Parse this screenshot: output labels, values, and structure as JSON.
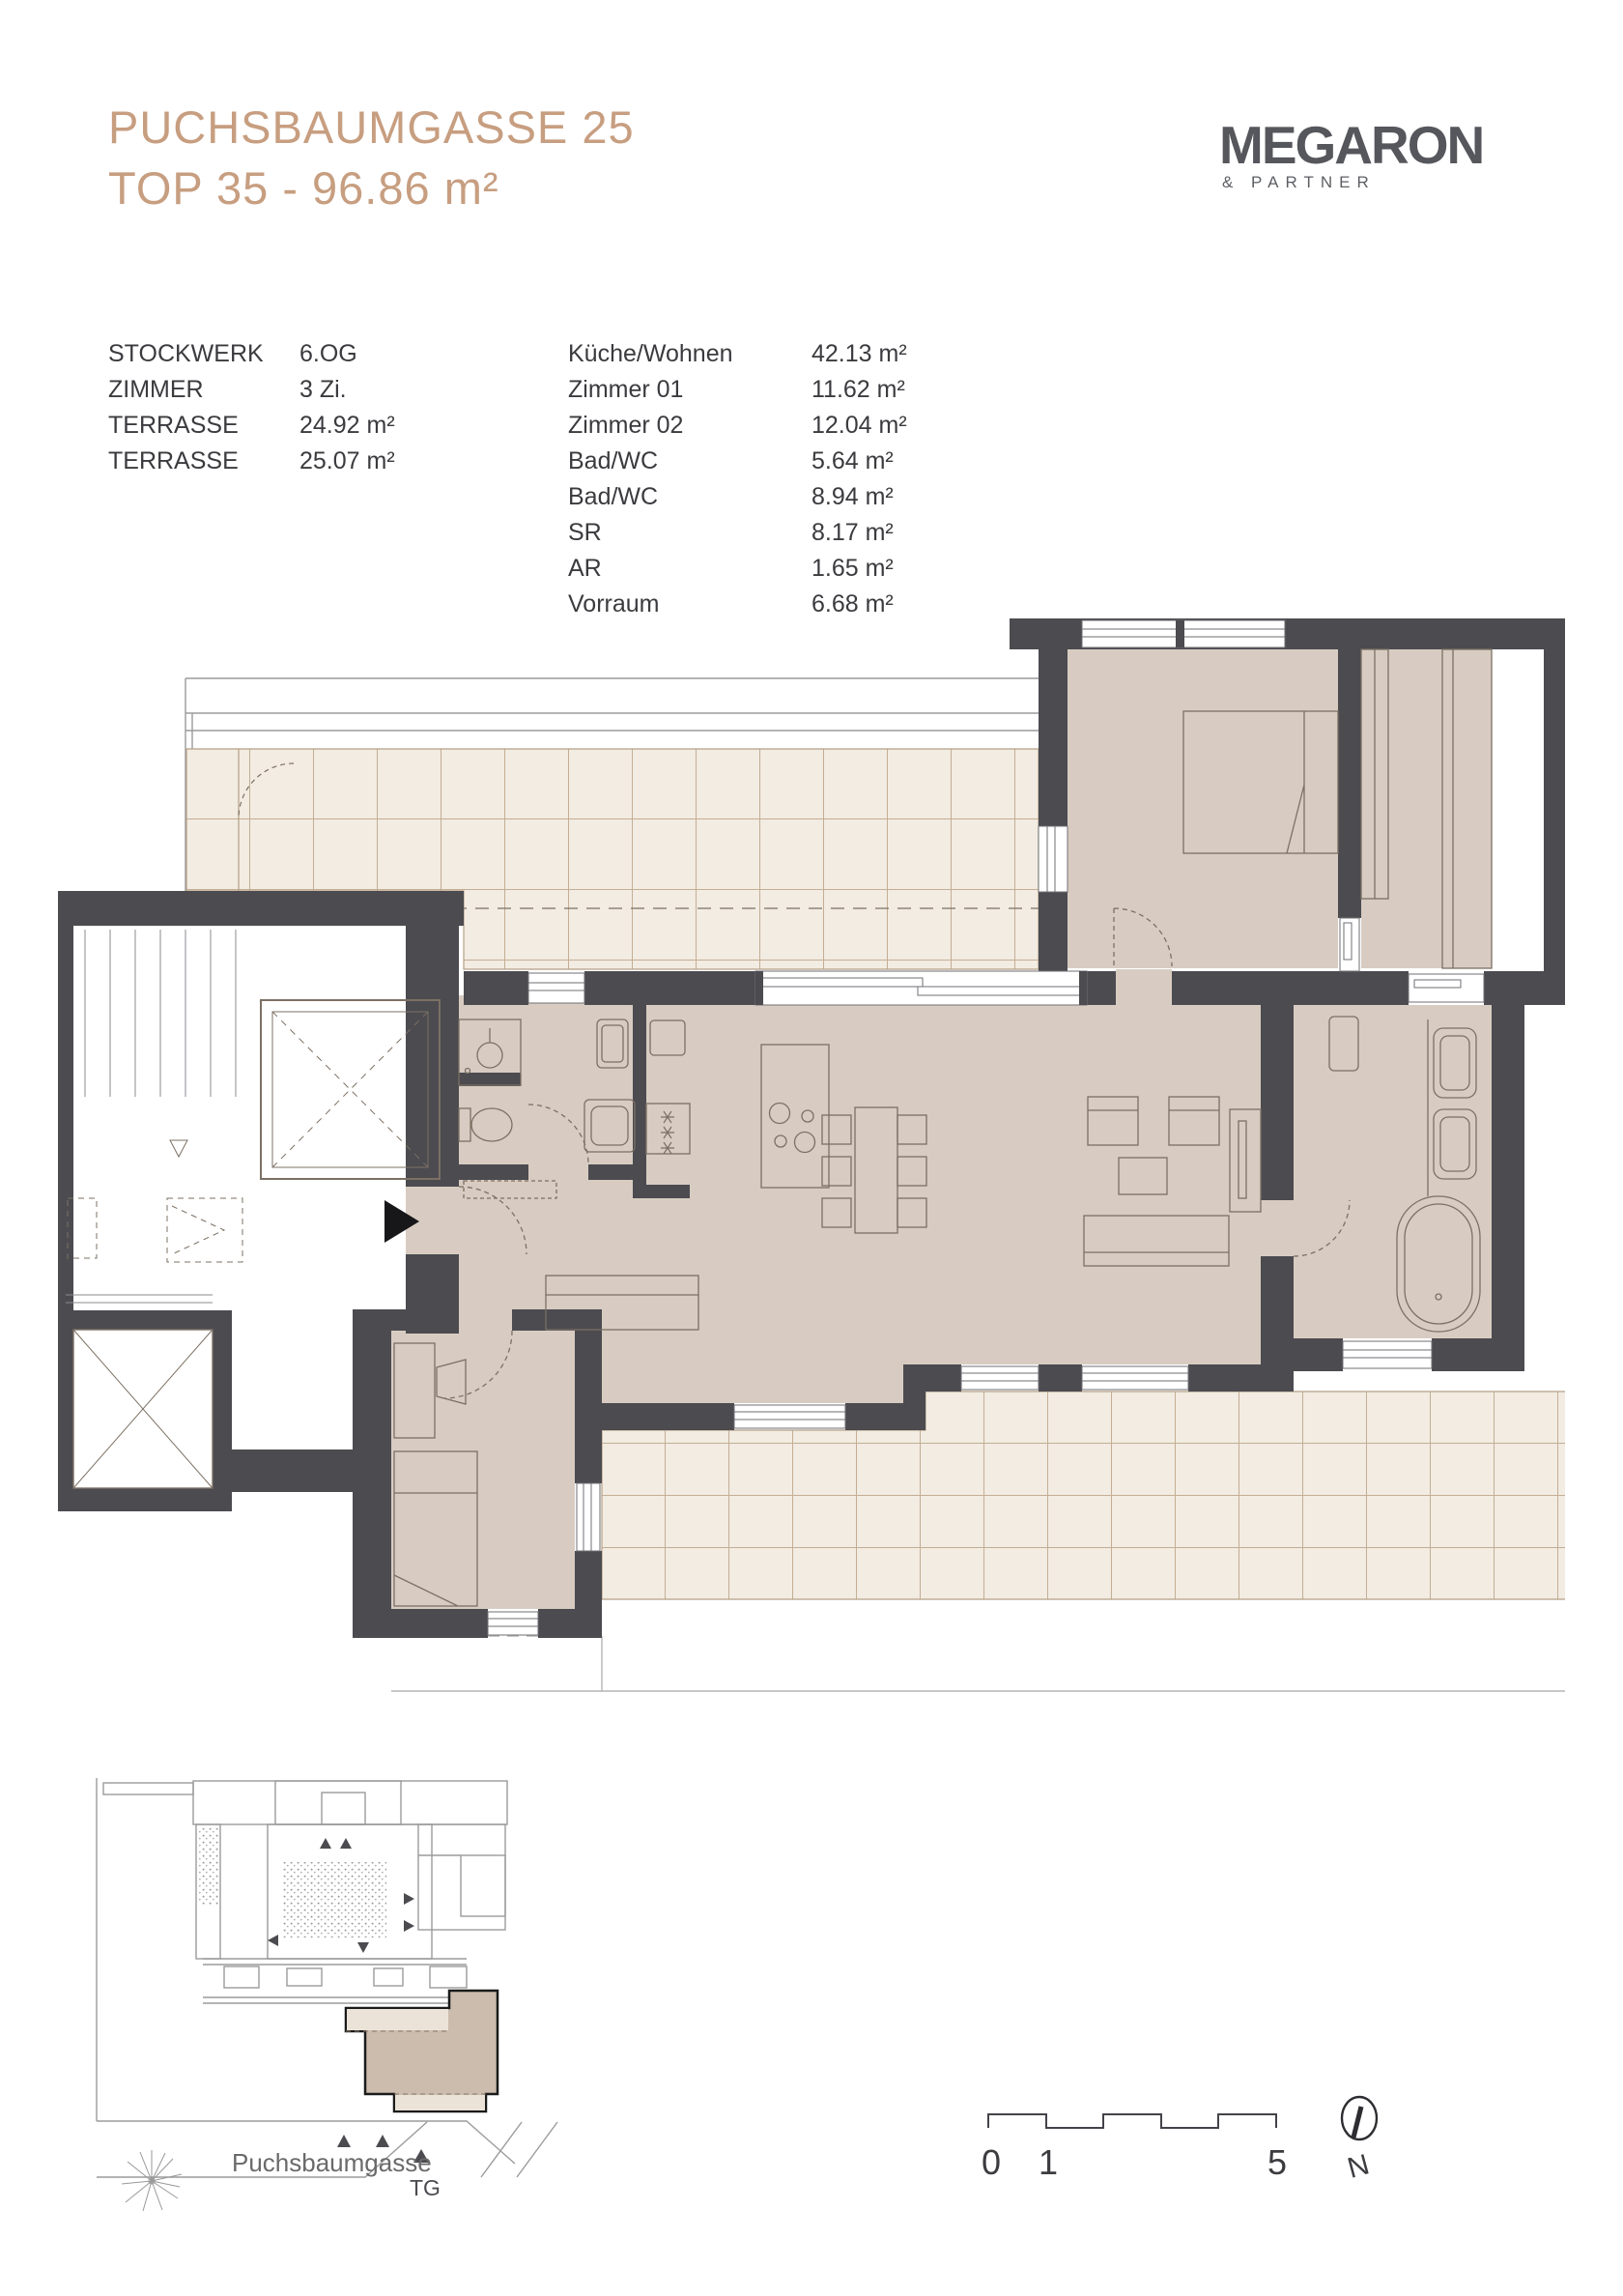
{
  "header": {
    "title_line1": "PUCHSBAUMGASSE 25",
    "title_line2": "TOP 35 - 96.86 m²"
  },
  "logo": {
    "name": "MEGARON",
    "subtitle": "& PARTNER"
  },
  "info": [
    {
      "label": "STOCKWERK",
      "value": "6.OG"
    },
    {
      "label": "ZIMMER",
      "value": "3 Zi."
    },
    {
      "label": "TERRASSE",
      "value": "24.92 m²"
    },
    {
      "label": "TERRASSE",
      "value": "25.07 m²"
    }
  ],
  "rooms": [
    {
      "name": "Küche/Wohnen",
      "area": "42.13 m²"
    },
    {
      "name": "Zimmer 01",
      "area": "11.62 m²"
    },
    {
      "name": "Zimmer 02",
      "area": "12.04 m²"
    },
    {
      "name": "Bad/WC",
      "area": "5.64 m²"
    },
    {
      "name": "Bad/WC",
      "area": "8.94 m²"
    },
    {
      "name": "SR",
      "area": "8.17 m²"
    },
    {
      "name": "AR",
      "area": "1.65 m²"
    },
    {
      "name": "Vorraum",
      "area": "6.68 m²"
    }
  ],
  "site": {
    "street_label": "Puchsbaumgasse",
    "garage_label": "TG"
  },
  "scale": {
    "start": "0",
    "first": "1",
    "end": "5"
  },
  "compass": {
    "north_label": "N"
  },
  "colors": {
    "accent_title": "#c79e80",
    "wall": "#4b4b50",
    "floor": "#d8ccc2",
    "terrace": "#f2ece2",
    "tile_line": "#c4ae94",
    "logo_gray": "#56575c"
  }
}
